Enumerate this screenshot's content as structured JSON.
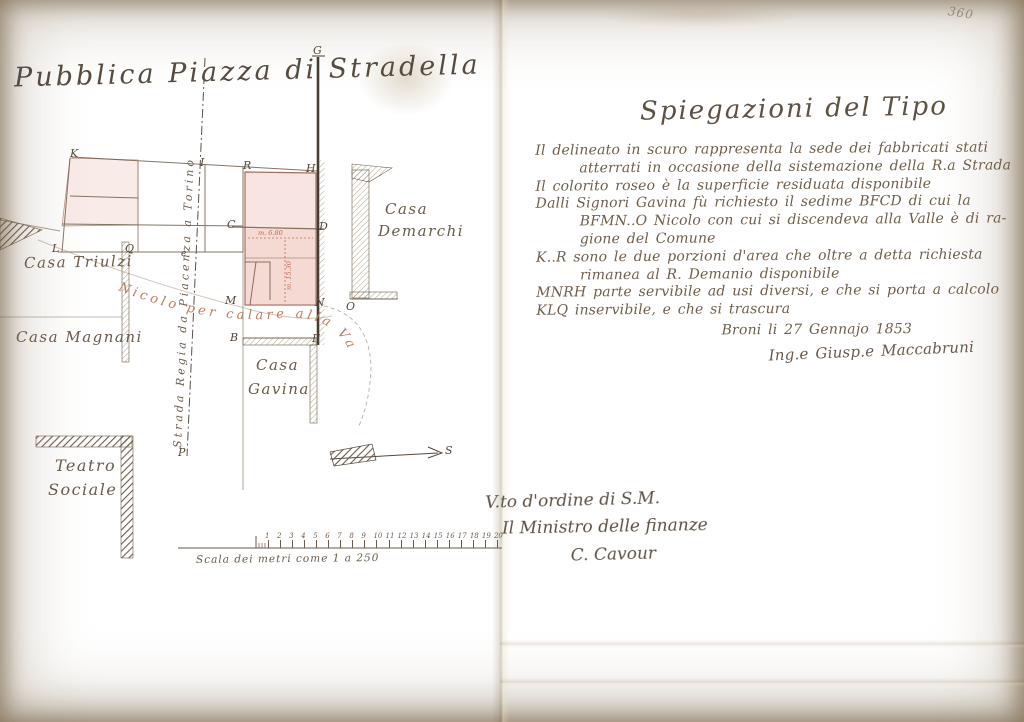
{
  "page": {
    "number": "360"
  },
  "map": {
    "title": "Pubblica Piazza di Stradella",
    "labels": {
      "casa_triulzi": "Casa Triulzi",
      "casa_magnani": "Casa Magnani",
      "casa_demarchi_1": "Casa",
      "casa_demarchi_2": "Demarchi",
      "casa_gavina_1": "Casa",
      "casa_gavina_2": "Gavina",
      "teatro_1": "Teatro",
      "teatro_2": "Sociale",
      "street": "Strada Regia da Piacenza a Torino",
      "alley": "Nicolo per calare alla Valle",
      "measure_h": "m. 6.80",
      "measure_v": "m. 15.30"
    },
    "letters": {
      "G": "G",
      "K": "K",
      "I": "I",
      "R": "R",
      "H": "H",
      "L": "L",
      "Q": "Q",
      "e": "e",
      "C": "C",
      "D": "D",
      "M": "M",
      "N": "N",
      "O": "O",
      "B": "B",
      "F": "F",
      "P": "P",
      "S": "S"
    },
    "scale": {
      "caption": "Scala dei metri come 1 a 250",
      "ticks": [
        "1",
        "2",
        "3",
        "4",
        "5",
        "6",
        "7",
        "8",
        "9",
        "10",
        "11",
        "12",
        "13",
        "14",
        "15",
        "16",
        "17",
        "18",
        "19",
        "20"
      ]
    }
  },
  "legend": {
    "title": "Spiegazioni del Tipo",
    "lines": [
      "Il delineato in scuro rappresenta la sede dei fabbricati stati",
      "atterrati in occasione della sistemazione della R.a Strada",
      "Il colorito roseo è la superficie residuata disponibile",
      "Dalli Signori Gavina fù richiesto il sedime BFCD di cui la",
      "BFMN..O Nicolo con cui si discendeva alla Valle è di ra-",
      "gione del Comune",
      "K..R sono le due porzioni d'area che oltre a detta richiesta",
      "rimanea al R. Demanio disponibile",
      "MNRH parte servibile ad usi diversi, e che si porta a calcolo",
      "KLQ inservibile, e che si trascura"
    ],
    "dateline": "Broni li 27 Gennajo 1853",
    "signature": "Ing.e Giusp.e Maccabruni"
  },
  "approval": {
    "order": "V.to d'ordine di S.M.",
    "minister": "Il Ministro delle finanze",
    "signature": "C. Cavour"
  },
  "colors": {
    "paper": "#e8d9b2",
    "ink": "#6a5a47",
    "red_ink": "#bb6e55",
    "pink": "#eec2b8"
  }
}
